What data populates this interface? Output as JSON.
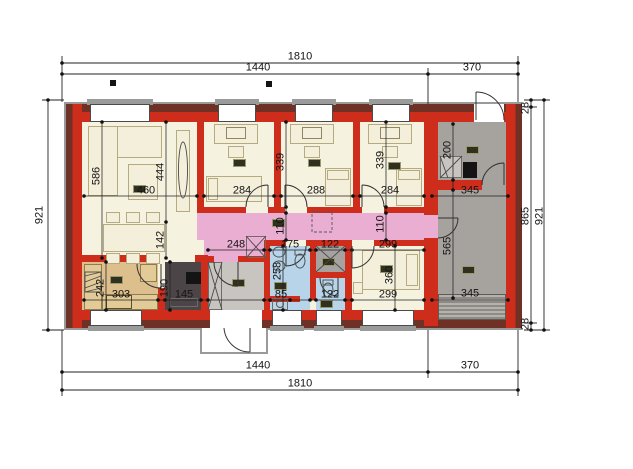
{
  "drawing": {
    "type": "architectural-floor-plan",
    "units": "centimeters"
  },
  "dims": {
    "top": {
      "total": "1810",
      "left": "1440",
      "right": "370"
    },
    "bottom": {
      "total": "1810",
      "left": "1440",
      "right": "370"
    },
    "left": {
      "total": "921"
    },
    "right": {
      "wall_top": "28",
      "interior": "865",
      "total": "921",
      "wall_bottom": "28"
    },
    "living": {
      "depth": "586",
      "width": "460",
      "right_depth": "444",
      "opening": "142"
    },
    "bedroom1": {
      "width": "284",
      "depth": "339"
    },
    "bedroom2": {
      "width": "288"
    },
    "bedroom3": {
      "width": "284",
      "depth": "339"
    },
    "utility": {
      "depth": "200",
      "width": "345"
    },
    "hall": {
      "height_left": "110",
      "height_right": "110",
      "width": "248"
    },
    "bathroom": {
      "width": "175",
      "depth": "258",
      "lower_width": "85"
    },
    "shower": {
      "width": "122"
    },
    "wc": {
      "width": "122"
    },
    "bedroom4": {
      "width_top": "299",
      "width_bottom": "299",
      "depth": "360"
    },
    "garage": {
      "depth": "565",
      "width": "345"
    },
    "kitchen": {
      "width": "303",
      "depth": "242"
    },
    "pantry": {
      "width": "145",
      "depth": "190"
    }
  },
  "colors": {
    "wall_red": "#cf2d1c",
    "wall_outer_dark": "#6f3026",
    "floor_cream": "#f6f2e0",
    "corridor_pink": "#e9aed2",
    "kitchen_tan": "#dcbf8d",
    "pantry_dark": "#4c4547",
    "vestibule_gray": "#c8c5c1",
    "bath_blue": "#b7d4e9",
    "garage_gray": "#a6a29d",
    "outline_gray": "#9a9a9a"
  }
}
